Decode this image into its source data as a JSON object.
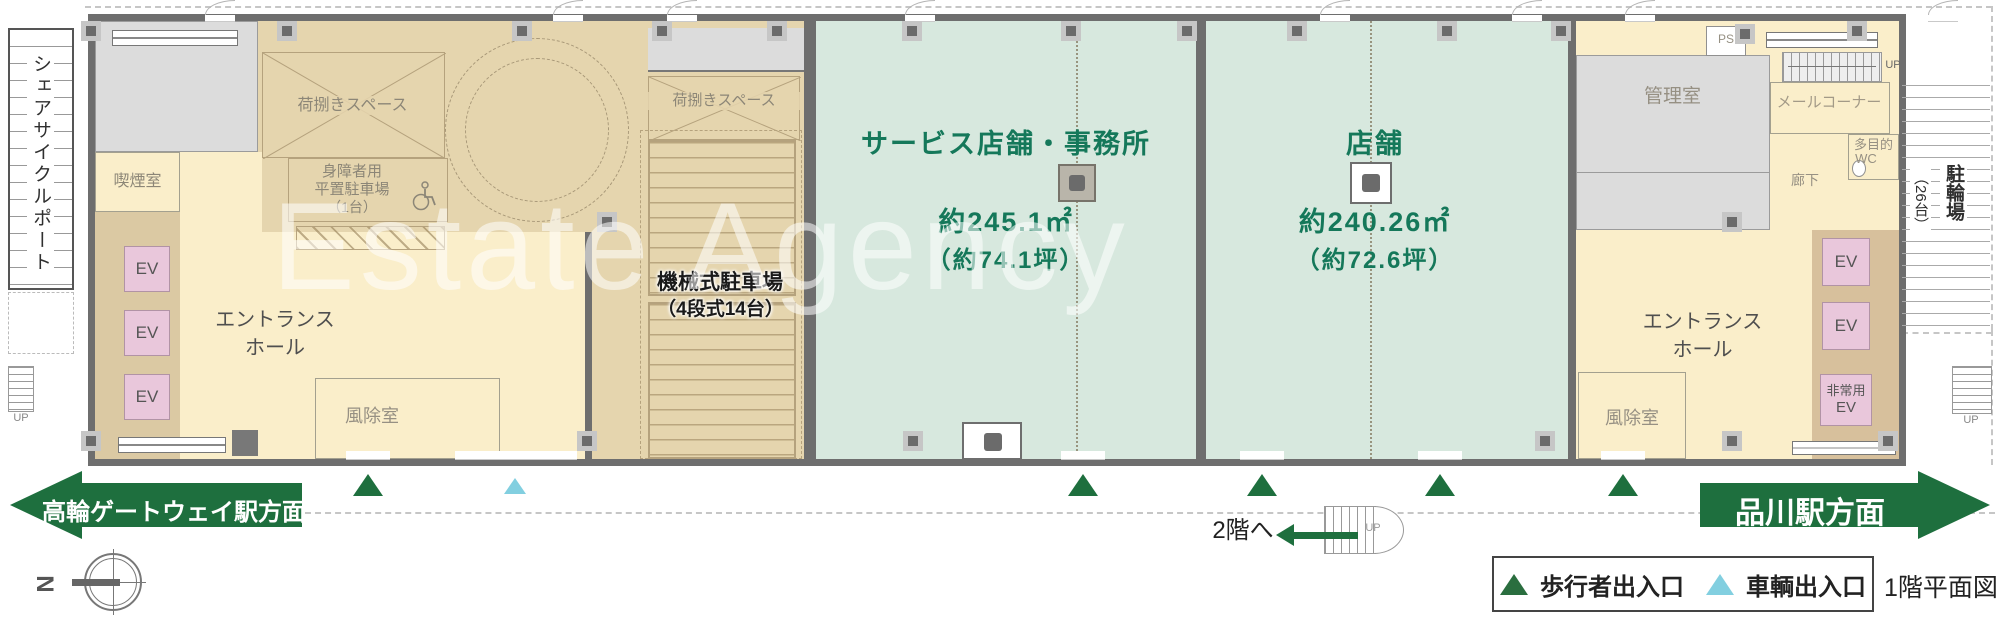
{
  "watermark": "Estate Agency",
  "outside": {
    "share_cycle_port": "シェアサイクルポート",
    "up": "UP",
    "bicycle_parking": "駐輪場",
    "bicycle_parking_count": "（26台）"
  },
  "rooms": {
    "smoking": "喫煙室",
    "loading_space": "荷捌きスペース",
    "disabled_parking": [
      "身障者用",
      "平置駐車場",
      "（1台）"
    ],
    "mechanical_parking": [
      "機械式駐車場",
      "（4段式14台）"
    ],
    "entrance_hall": [
      "エントランス",
      "ホール"
    ],
    "windbreak": "風除室",
    "manager": "管理室",
    "ps": "PS",
    "mail_corner": "メールコーナー",
    "multipurpose_wc": [
      "多目的",
      "WC"
    ],
    "corridor": "廊下",
    "ev": "EV",
    "emergency_ev": [
      "非常用",
      "EV"
    ]
  },
  "tenants": [
    {
      "name": "サービス店舗・事務所",
      "area_sqm": "約245.1㎡",
      "area_tsubo": "（約74.1坪）"
    },
    {
      "name": "店舗",
      "area_sqm": "約240.26㎡",
      "area_tsubo": "（約72.6坪）"
    }
  ],
  "navigation": {
    "left_direction": "高輪ゲートウェイ駅方面",
    "right_direction": "品川駅方面",
    "to_second_floor": "2階へ",
    "stair_up": "UP"
  },
  "legend": {
    "pedestrian_entrance": "歩行者出入口",
    "vehicle_entrance": "車輌出入口"
  },
  "plan_title": "1階平面図",
  "compass_north": "N",
  "colors": {
    "tenant_bg": "#d7e8de",
    "tenant_text": "#15785a",
    "cream": "#faeeca",
    "tan": "#e5d5ae",
    "ev_pink": "#e9c7db",
    "arrow_green": "#1e6f3e",
    "vehicle_blue": "#82cfe0",
    "wall_gray": "#6e6e6e"
  }
}
